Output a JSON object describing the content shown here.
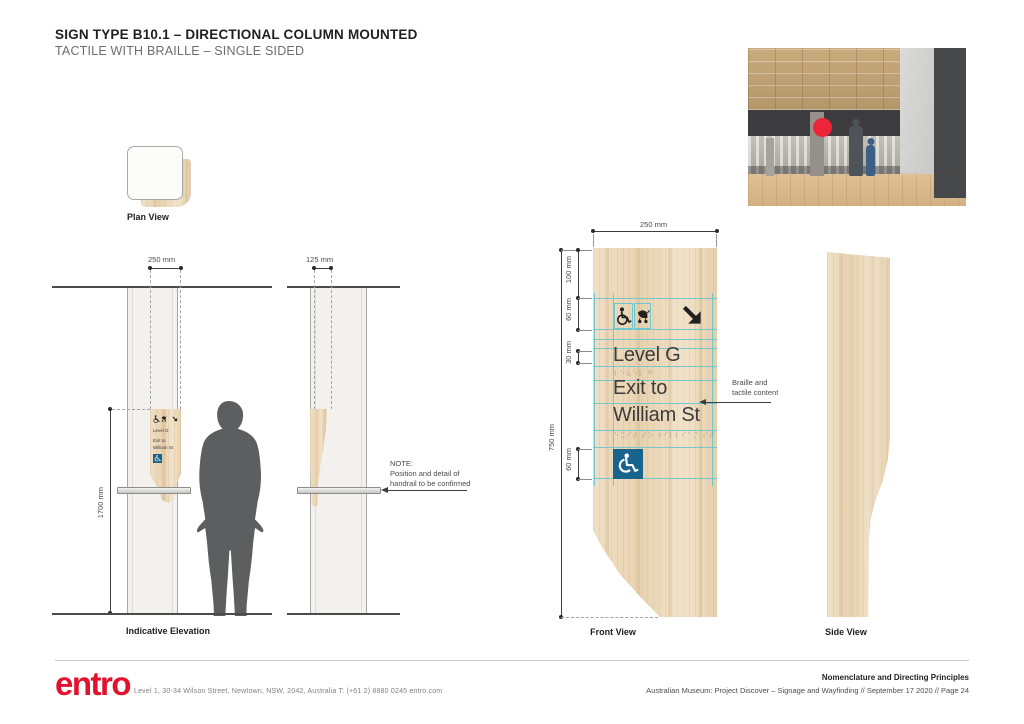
{
  "page": {
    "title": "SIGN TYPE B10.1 – DIRECTIONAL COLUMN MOUNTED",
    "subtitle": "TACTILE WITH BRAILLE – SINGLE SIDED"
  },
  "colors": {
    "accent_red": "#e4112e",
    "access_blue": "#19648f",
    "guide_teal": "#62c4d0",
    "wood_tan": "#e9d6b8"
  },
  "plan_view": {
    "label": "Plan View"
  },
  "indicative_elevation": {
    "label": "Indicative Elevation",
    "dim_width": "250 mm",
    "dim_height": "1700 mm"
  },
  "side_elevation": {
    "dim_width": "125 mm",
    "note_line1": "NOTE:",
    "note_line2": "Position and detail of",
    "note_line3": "handrail to be confirmed"
  },
  "front_view": {
    "label": "Front View",
    "dim_width": "250 mm",
    "dim_total_height": "750 mm",
    "dim_top_margin": "100 mm",
    "dim_icon_row": "60 mm",
    "dim_text_height": "30 mm",
    "dim_access_symbol": "60 mm",
    "callout_line1": "Braille and",
    "callout_line2": "tactile content",
    "sign": {
      "line1": "Level G",
      "line2": "Exit to",
      "line3": "William St",
      "braille1": "⠇⠑⠧⠑⠇ ⠛",
      "braille2": "⠑⠭⠊⠞ ⠞⠕ ⠺⠊⠇⠇⠊⠁⠍ ⠎⠞"
    }
  },
  "side_view": {
    "label": "Side View"
  },
  "footer": {
    "logo": "entro",
    "address": "Level 1, 30-34 Wilson Street, Newtown, NSW, 2042, Australia  T: (+61 2) 8880 0245  entro.com",
    "doc_title": "Nomenclature and Directing Principles",
    "doc_info": "Australian Museum: Project Discover  –  Signage and Wayfinding // September 17 2020 // Page 24"
  }
}
